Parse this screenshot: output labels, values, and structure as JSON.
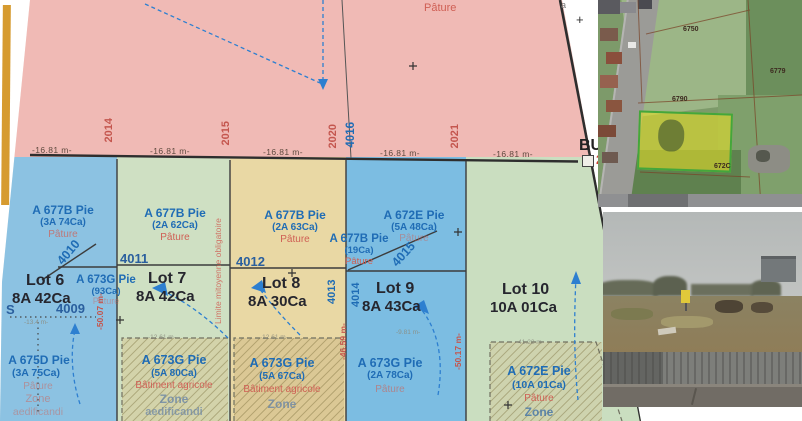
{
  "plan": {
    "pasture_top": "Pâture",
    "top_measure": "-16.81 m-",
    "frame_numbers": {
      "a2014": "2014",
      "a2015": "2015",
      "a2020": "2020",
      "a4016": "4016",
      "a2021": "2021"
    },
    "points": {
      "p4009": "4009",
      "p4010": "4010",
      "p4011": "4011",
      "p4012": "4012",
      "p4013": "4013",
      "p4014": "4014",
      "p4015": "4015"
    },
    "lots": [
      {
        "name": "Lot 6",
        "area": "8A 42Ca"
      },
      {
        "name": "Lot 7",
        "area": "8A 42Ca"
      },
      {
        "name": "Lot 8",
        "area": "8A 30Ca"
      },
      {
        "name": "Lot 9",
        "area": "8A 43Ca"
      },
      {
        "name": "Lot 10",
        "area": "10A 01Ca"
      }
    ],
    "parcels": {
      "p677b74": {
        "ref": "A 677B Pie",
        "area": "(3A 74Ca)",
        "use": "Pâture"
      },
      "p677b62": {
        "ref": "A 677B Pie",
        "area": "(2A 62Ca)",
        "use": "Pâture"
      },
      "p677b63": {
        "ref": "A 677B Pie",
        "area": "(2A 63Ca)",
        "use": "Pâture"
      },
      "p672e48": {
        "ref": "A 672E Pie",
        "area": "(5A 48Ca)",
        "use": "Pâture"
      },
      "p677b19": {
        "ref": "A 677B Pie",
        "area": "(19Ca)",
        "use": "Pâture"
      },
      "p673g93": {
        "ref": "A 673G Pie",
        "area": "(93Ca)",
        "use": "Pâture"
      },
      "p675d75": {
        "ref": "A 675D Pie",
        "area": "(3A 75Ca)",
        "use": "Pâture",
        "zone": "Zone",
        "zone2": "aedificandi"
      },
      "p673g80": {
        "ref": "A 673G Pie",
        "area": "(5A 80Ca)",
        "use": "Bâtiment agricole",
        "zone": "Zone",
        "zone2": "aedificandi"
      },
      "p673g67": {
        "ref": "A 673G Pie",
        "area": "(5A 67Ca)",
        "use": "Bâtiment agricole",
        "zone": "Zone"
      },
      "p673g78": {
        "ref": "A 673G Pie",
        "area": "(2A 78Ca)",
        "use": "Pâture"
      },
      "p672e101": {
        "ref": "A 672E Pie",
        "area": "(10A 01Ca)",
        "use": "Pâture",
        "zone": "Zone"
      }
    },
    "limit_note": "Limite mitoyenne obligatoire",
    "side_measures": {
      "m1": "-50.07 m-",
      "m2": "-46.59 m-",
      "m3": "-50.17 m-"
    },
    "small_measures": {
      "m134": "-13.4 m-",
      "m1261": "-12.61 m-",
      "m981": "-9.81 m-",
      "m4122": "-41.22 m-"
    },
    "edge": {
      "bu": "BU",
      "two": "2",
      "a": "a",
      "s": "S"
    }
  },
  "satellite": {
    "labels": {
      "l6750": "6750",
      "l6779": "6779",
      "l6790": "6790",
      "l672c": "672C"
    },
    "highlight_color": "#d8d21a"
  },
  "colors": {
    "pink": "#f0bab5",
    "blue_lot6": "#8cc2e2",
    "green_lot7": "#cfe0c3",
    "yellow_lot8": "#e9d8a4",
    "blue_lot9": "#7cbde2",
    "green_lot10": "#cadec0",
    "parcel_text": "#1f6cb5",
    "red_text": "#cf5f54"
  }
}
